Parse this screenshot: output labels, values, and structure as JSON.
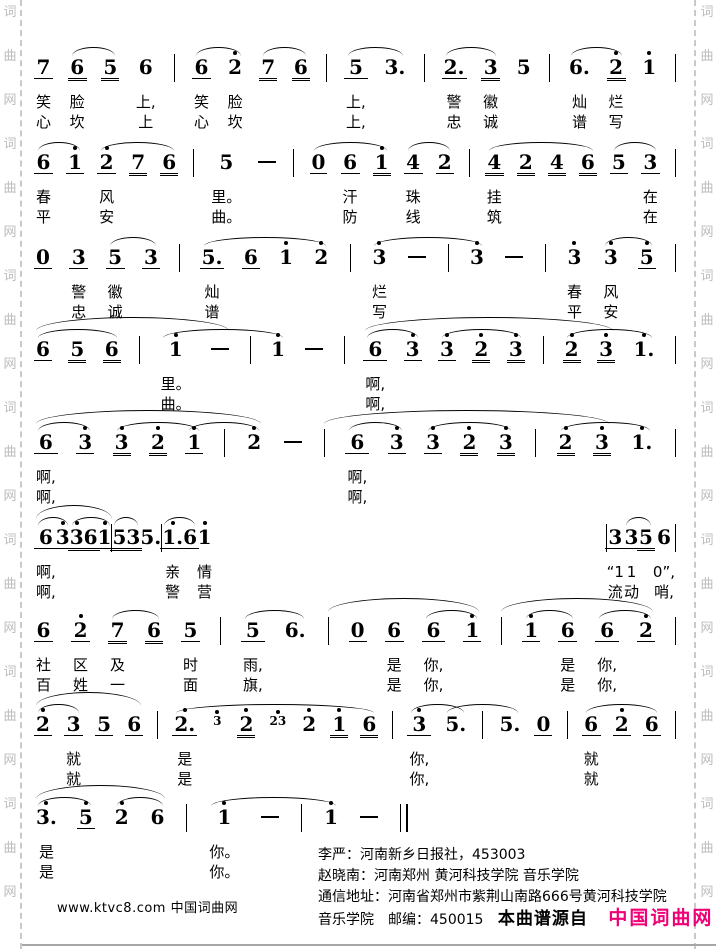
{
  "page": {
    "watermark_text": "词曲网",
    "watermark_color": "#bcbcbc",
    "brand_pink": "#ee0077",
    "site_label": "www.ktvc8.com 中国词曲网",
    "credits": [
      "李严：河南新乡日报社，453003",
      "赵晓南：河南郑州 黄河科技学院 音乐学院",
      "通信地址：河南省郑州市紫荆山南路666号黄河科技学院",
      "音乐学院　邮编：450015"
    ],
    "source_bold": "本曲谱源自",
    "source_brand": "中国词曲网"
  },
  "score": {
    "lines": [
      {
        "top": 50,
        "width": 640,
        "cells": [
          {
            "n": "7",
            "u": 1,
            "l1": "笑",
            "l2": "心"
          },
          {
            "n": "6",
            "u": 2,
            "arc": 2,
            "l1": "脸",
            "l2": "坎"
          },
          {
            "n": "5",
            "u": 2
          },
          {
            "n": "6",
            "l1": "上,",
            "l2": "上"
          },
          {
            "bar": 1
          },
          {
            "n": "6",
            "u": 1,
            "arc": 2,
            "l1": "笑",
            "l2": "心"
          },
          {
            "n": "2",
            "hd": 1,
            "l1": "脸",
            "l2": "坎"
          },
          {
            "n": "7",
            "u": 2,
            "arc": 2
          },
          {
            "n": "6",
            "u": 2
          },
          {
            "bar": 1
          },
          {
            "n": "5",
            "u": 1,
            "arc": 2,
            "l1": "上,",
            "l2": "上,"
          },
          {
            "n": "3."
          },
          {
            "bar": 1
          },
          {
            "n": "2.",
            "u": 1,
            "arc": 2,
            "l1": "警",
            "l2": "忠"
          },
          {
            "n": "3",
            "u": 2,
            "l1": "徽",
            "l2": "诚"
          },
          {
            "n": "5"
          },
          {
            "bar": 1
          },
          {
            "n": "6.",
            "arc": 2,
            "l1": "灿",
            "l2": "谱"
          },
          {
            "n": "2",
            "hd": 1,
            "u": 2,
            "l1": "烂",
            "l2": "写"
          },
          {
            "n": "1",
            "hd": 1
          },
          {
            "bar": 1
          }
        ]
      },
      {
        "top": 145,
        "width": 640,
        "cells": [
          {
            "n": "6",
            "u": 1,
            "arc": 2,
            "l1": "春",
            "l2": "平"
          },
          {
            "n": "1",
            "hd": 1,
            "u": 1
          },
          {
            "n": "2",
            "hd": 1,
            "u": 1,
            "arc": 3,
            "l1": "风",
            "l2": "安"
          },
          {
            "n": "7",
            "u": 2
          },
          {
            "n": "6",
            "u": 2
          },
          {
            "bar": 1
          },
          {
            "n": "5",
            "l1": "里。",
            "l2": "曲。"
          },
          {
            "dash": 1
          },
          {
            "bar": 1
          },
          {
            "n": "0",
            "u": 1,
            "arc": 3
          },
          {
            "n": "6",
            "u": 1,
            "l1": "汗",
            "l2": "防"
          },
          {
            "n": "1",
            "hd": 1,
            "u": 2
          },
          {
            "n": "4",
            "u": 1,
            "arc": 2,
            "l1": "珠",
            "l2": "线"
          },
          {
            "n": "2",
            "u": 1
          },
          {
            "bar": 1
          },
          {
            "n": "4",
            "u": 2,
            "arc": 4,
            "l1": "挂",
            "l2": "筑"
          },
          {
            "n": "2",
            "u": 2
          },
          {
            "n": "4",
            "u": 2
          },
          {
            "n": "6",
            "u": 2
          },
          {
            "n": "5",
            "u": 1,
            "arc": 2
          },
          {
            "n": "3",
            "u": 1,
            "l1": "在",
            "l2": "在"
          },
          {
            "bar": 1
          }
        ]
      },
      {
        "top": 240,
        "width": 640,
        "cells": [
          {
            "n": "0",
            "u": 1
          },
          {
            "n": "3",
            "u": 1,
            "l1": "警",
            "l2": "忠"
          },
          {
            "n": "5",
            "u": 1,
            "arc": 2,
            "l1": "徽",
            "l2": "诚"
          },
          {
            "n": "3",
            "u": 1
          },
          {
            "bar": 1
          },
          {
            "n": "5.",
            "u": 1,
            "arc": 4,
            "l1": "灿",
            "l2": "谱"
          },
          {
            "n": "6",
            "u": 1
          },
          {
            "n": "1",
            "hd": 1
          },
          {
            "n": "2",
            "hd": 1
          },
          {
            "bar": 1
          },
          {
            "n": "3",
            "hd": 1,
            "arc": 4,
            "l1": "烂",
            "l2": "写"
          },
          {
            "dash": 1
          },
          {
            "bar": 1
          },
          {
            "n": "3",
            "hd": 1
          },
          {
            "dash": 1
          },
          {
            "bar": 1
          },
          {
            "n": "3",
            "hd": 1,
            "l1": "春",
            "l2": "平"
          },
          {
            "n": "3",
            "hd": 1,
            "arc": 2,
            "l1": "风",
            "l2": "安"
          },
          {
            "n": "5",
            "hd": 1,
            "u": 1
          },
          {
            "bar": 1
          }
        ]
      },
      {
        "top": 332,
        "width": 640,
        "phrases": [
          {
            "s": 0,
            "e": 5
          },
          {
            "s": 10,
            "e": 17
          }
        ],
        "cells": [
          {
            "n": "6",
            "u": 1,
            "arc": 3
          },
          {
            "n": "5",
            "u": 2
          },
          {
            "n": "6",
            "u": 2
          },
          {
            "bar": 1
          },
          {
            "n": "1",
            "hd": 1,
            "arc": 4,
            "l1": "里。",
            "l2": "曲。"
          },
          {
            "dash": 1
          },
          {
            "bar": 1
          },
          {
            "n": "1",
            "hd": 1
          },
          {
            "dash": 1
          },
          {
            "bar": 1
          },
          {
            "n": "6",
            "u": 1,
            "arc": 2,
            "l1": "啊,",
            "l2": "啊,"
          },
          {
            "n": "3",
            "hd": 1,
            "u": 1
          },
          {
            "n": "3",
            "hd": 1,
            "u": 1,
            "arc": 3
          },
          {
            "n": "2",
            "hd": 1,
            "u": 2
          },
          {
            "n": "3",
            "hd": 1,
            "u": 2
          },
          {
            "bar": 1
          },
          {
            "n": "2",
            "hd": 1,
            "u": 2,
            "arc": 3
          },
          {
            "n": "3",
            "hd": 1,
            "u": 2
          },
          {
            "n": "1.",
            "hd": 1
          },
          {
            "bar": 1
          }
        ]
      },
      {
        "top": 425,
        "width": 640,
        "phrases": [
          {
            "s": 0,
            "e": 6
          },
          {
            "s": 8,
            "e": 16
          }
        ],
        "cells": [
          {
            "n": "6",
            "u": 1,
            "arc": 2,
            "l1": "啊,",
            "l2": "啊,"
          },
          {
            "n": "3",
            "hd": 1,
            "u": 1
          },
          {
            "n": "3",
            "hd": 1,
            "u": 2,
            "arc": 3
          },
          {
            "n": "2",
            "hd": 1,
            "u": 2
          },
          {
            "n": "1",
            "hd": 1,
            "u": 1,
            "arc": 3
          },
          {
            "bar": 1
          },
          {
            "n": "2",
            "hd": 1
          },
          {
            "dash": 1
          },
          {
            "bar": 1
          },
          {
            "n": "6",
            "u": 1,
            "arc": 2,
            "l1": "啊,",
            "l2": "啊,"
          },
          {
            "n": "3",
            "hd": 1,
            "u": 1
          },
          {
            "n": "3",
            "hd": 1,
            "u": 1,
            "arc": 3
          },
          {
            "n": "2",
            "hd": 1,
            "u": 2
          },
          {
            "n": "3",
            "hd": 1,
            "u": 2
          },
          {
            "bar": 1
          },
          {
            "n": "2",
            "hd": 1,
            "u": 2,
            "arc": 3
          },
          {
            "n": "3",
            "hd": 1,
            "u": 2
          },
          {
            "n": "1.",
            "hd": 1
          },
          {
            "bar": 1
          }
        ]
      },
      {
        "top": 520,
        "width": 640,
        "phrases": [
          {
            "s": 0,
            "e": 4
          }
        ],
        "cells": [
          {
            "n": "6",
            "u": 1,
            "arc": 2,
            "l1": "啊,",
            "l2": "啊,"
          },
          {
            "n": "3",
            "hd": 1,
            "u": 1
          },
          {
            "n": "3",
            "hd": 1,
            "u": 2,
            "arc": 3
          },
          {
            "n": "6",
            "u": 2
          },
          {
            "n": "1",
            "hd": 1,
            "u": 1
          },
          {
            "bar": 1
          },
          {
            "n": "5",
            "u": 2,
            "arc": 2
          },
          {
            "n": "3",
            "u": 2
          },
          {
            "n": "5."
          },
          {
            "bar": 1
          },
          {
            "n": "1.",
            "hd": 1,
            "u": 1,
            "arc": 2,
            "l1": "亲",
            "l2": "警"
          },
          {
            "n": "6",
            "u": 1
          },
          {
            "n": "1",
            "hd": 1,
            "l1": "情",
            "l2": "营"
          },
          {
            "spacer": 1
          },
          {
            "bar": 1
          },
          {
            "n": "3",
            "u": 1,
            "l1": "“1",
            "l2": "流"
          },
          {
            "n": "3",
            "u": 1,
            "arc": 2,
            "l1": "1",
            "l2": "动"
          },
          {
            "n": "5",
            "u": 2
          },
          {
            "n": "6",
            "l1": "0”,",
            "l2": "哨,"
          },
          {
            "bar": 1
          }
        ]
      },
      {
        "top": 613,
        "width": 640,
        "phrases": [
          {
            "s": 8,
            "e": 12
          },
          {
            "s": 13,
            "e": 17
          }
        ],
        "cells": [
          {
            "n": "6",
            "u": 1,
            "l1": "社",
            "l2": "百"
          },
          {
            "n": "2",
            "hd": 1,
            "u": 1,
            "l1": "区",
            "l2": "姓"
          },
          {
            "n": "7",
            "u": 2,
            "arc": 2,
            "l1": "及",
            "l2": "一"
          },
          {
            "n": "6",
            "u": 2
          },
          {
            "n": "5",
            "u": 1,
            "l1": "时",
            "l2": "面"
          },
          {
            "bar": 1
          },
          {
            "n": "5",
            "u": 1,
            "arc": 2,
            "l1": "雨,",
            "l2": "旗,"
          },
          {
            "n": "6."
          },
          {
            "bar": 1
          },
          {
            "n": "0",
            "u": 1
          },
          {
            "n": "6",
            "u": 1,
            "l1": "是",
            "l2": "是"
          },
          {
            "n": "6",
            "u": 1,
            "arc": 2,
            "l1": "你,",
            "l2": "你,"
          },
          {
            "n": "1",
            "hd": 1,
            "u": 1
          },
          {
            "bar": 1
          },
          {
            "n": "1",
            "hd": 1,
            "u": 1,
            "arc": 2
          },
          {
            "n": "6",
            "u": 1,
            "l1": "是",
            "l2": "是"
          },
          {
            "n": "6",
            "u": 1,
            "arc": 2,
            "l1": "你,",
            "l2": "你,"
          },
          {
            "n": "2",
            "hd": 1,
            "u": 1
          },
          {
            "bar": 1
          }
        ]
      },
      {
        "top": 707,
        "width": 640,
        "phrases": [
          {
            "s": 0,
            "e": 3
          }
        ],
        "cells": [
          {
            "n": "2",
            "hd": 1,
            "u": 1,
            "arc": 2
          },
          {
            "n": "3",
            "u": 1,
            "l1": "就",
            "l2": "就"
          },
          {
            "n": "5",
            "u": 1
          },
          {
            "n": "6",
            "u": 1
          },
          {
            "bar": 1
          },
          {
            "n": "2.",
            "hd": 1,
            "u": 1,
            "arc": 7,
            "l1": "是",
            "l2": "是"
          },
          {
            "g": "3",
            "hd": 1
          },
          {
            "n": "2",
            "hd": 1,
            "u": 2
          },
          {
            "g": "23",
            "hd": 1
          },
          {
            "n": "2",
            "hd": 1
          },
          {
            "n": "1",
            "hd": 1,
            "u": 2
          },
          {
            "n": "6",
            "u": 2
          },
          {
            "bar": 1
          },
          {
            "n": "3",
            "hd": 1,
            "u": 1,
            "arc": 2,
            "l1": "你,",
            "l2": "你,"
          },
          {
            "n": "5.",
            "arc": 3
          },
          {
            "bar": 1
          },
          {
            "n": "5."
          },
          {
            "n": "0",
            "u": 1
          },
          {
            "bar": 1
          },
          {
            "n": "6",
            "u": 1,
            "arc": 3,
            "l1": "就",
            "l2": "就"
          },
          {
            "n": "2",
            "hd": 1,
            "u": 1
          },
          {
            "n": "6",
            "u": 1
          },
          {
            "bar": 1
          }
        ]
      },
      {
        "top": 800,
        "width": 372,
        "phrases": [
          {
            "s": 0,
            "e": 3
          }
        ],
        "cells": [
          {
            "n": "3.",
            "hd": 1,
            "arc": 2,
            "l1": "是",
            "l2": "是"
          },
          {
            "n": "5",
            "hd": 1,
            "u": 1
          },
          {
            "n": "2",
            "hd": 1,
            "arc": 2
          },
          {
            "n": "6"
          },
          {
            "bar": 1
          },
          {
            "n": "1",
            "hd": 1,
            "arc": 4,
            "l1": "你。",
            "l2": "你。"
          },
          {
            "dash": 1
          },
          {
            "bar": 1
          },
          {
            "n": "1",
            "hd": 1
          },
          {
            "dash": 1
          },
          {
            "bar": "final"
          }
        ]
      }
    ]
  }
}
